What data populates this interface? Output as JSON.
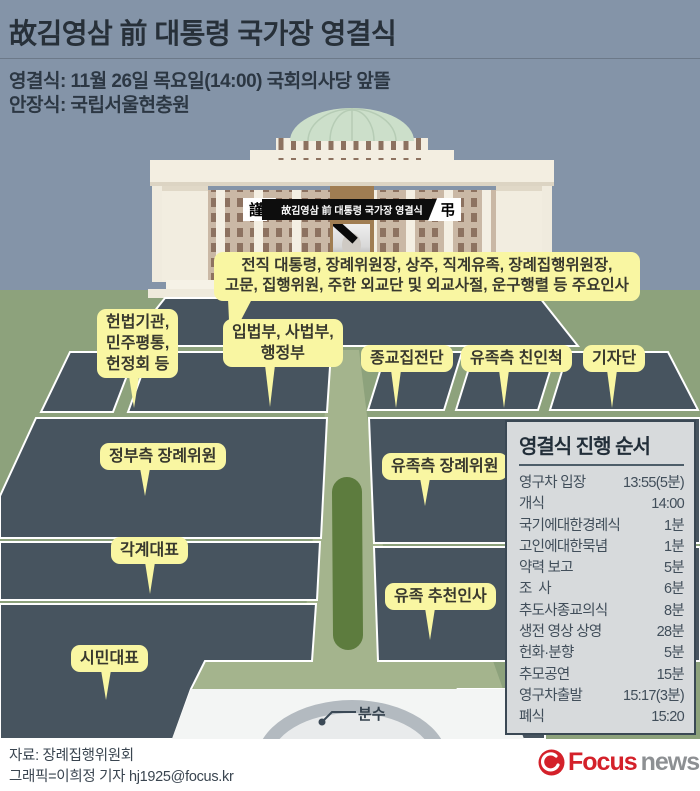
{
  "header": {
    "title": "故김영삼 前 대통령 국가장 영결식",
    "line1": "영결식: 11월 26일 목요일(14:00) 국회의사당 앞뜰",
    "line2": "안장식: 국립서울현충원"
  },
  "banner": {
    "left_char": "謹",
    "right_char": "弔",
    "text": "故김영삼 前 대통령 국가장 영결식"
  },
  "labels": {
    "vip": "전직 대통령, 장례위원장, 상주, 직계유족, 장례집행위원장,\n고문, 집행위원, 주한 외교단 및 외교사절, 운구행렬 등 주요인사",
    "constitutional": "헌법기관,\n민주평통,\n헌정회 등",
    "branches": "입법부, 사법부,\n행정부",
    "religious": "종교집전단",
    "family_relatives": "유족측 친인척",
    "press": "기자단",
    "gov_committee": "정부측 장례위원",
    "family_committee": "유족측 장례위원",
    "sector_reps": "각계대표",
    "family_nominees": "유족 추천인사",
    "citizen_reps": "시민대표",
    "fountain": "분수"
  },
  "schedule": {
    "title": "영결식 진행 순서",
    "rows": [
      {
        "label": "영구차 입장",
        "value": "13:55(5분)"
      },
      {
        "label": "개식",
        "value": "14:00"
      },
      {
        "label": "국기에대한경례식",
        "value": "1분"
      },
      {
        "label": "고인에대한묵념",
        "value": "1분"
      },
      {
        "label": "약력 보고",
        "value": "5분"
      },
      {
        "label": "조  사",
        "value": "6분"
      },
      {
        "label": "추도사종교의식",
        "value": "8분"
      },
      {
        "label": "생전 영상 상영",
        "value": "28분"
      },
      {
        "label": "헌화·분향",
        "value": "5분"
      },
      {
        "label": "추모공연",
        "value": "15분"
      },
      {
        "label": "영구차출발",
        "value": "15:17(3분)"
      },
      {
        "label": "폐식",
        "value": "15:20"
      }
    ]
  },
  "footer": {
    "source": "자료: 장례집행위원회",
    "credit": "그래픽=이희정 기자 hj1925@focus.kr",
    "brand": {
      "name": "Focus",
      "suffix": "news"
    }
  },
  "colors": {
    "sky": "#8494A8",
    "lawn": "#8DA27C",
    "road": "#A4B48D",
    "median_green": "#5D7C3E",
    "seating_block": "#47545F",
    "callout_yellow": "#F9F6A2",
    "panel_bg": "#D7DADC",
    "panel_border": "#3A4854",
    "building_cream": "#F3EEE1",
    "building_wall": "#CAB8A5",
    "dome_green": "#CCDFCA",
    "focus_red": "#D4212A",
    "news_gray": "#8D9093"
  }
}
